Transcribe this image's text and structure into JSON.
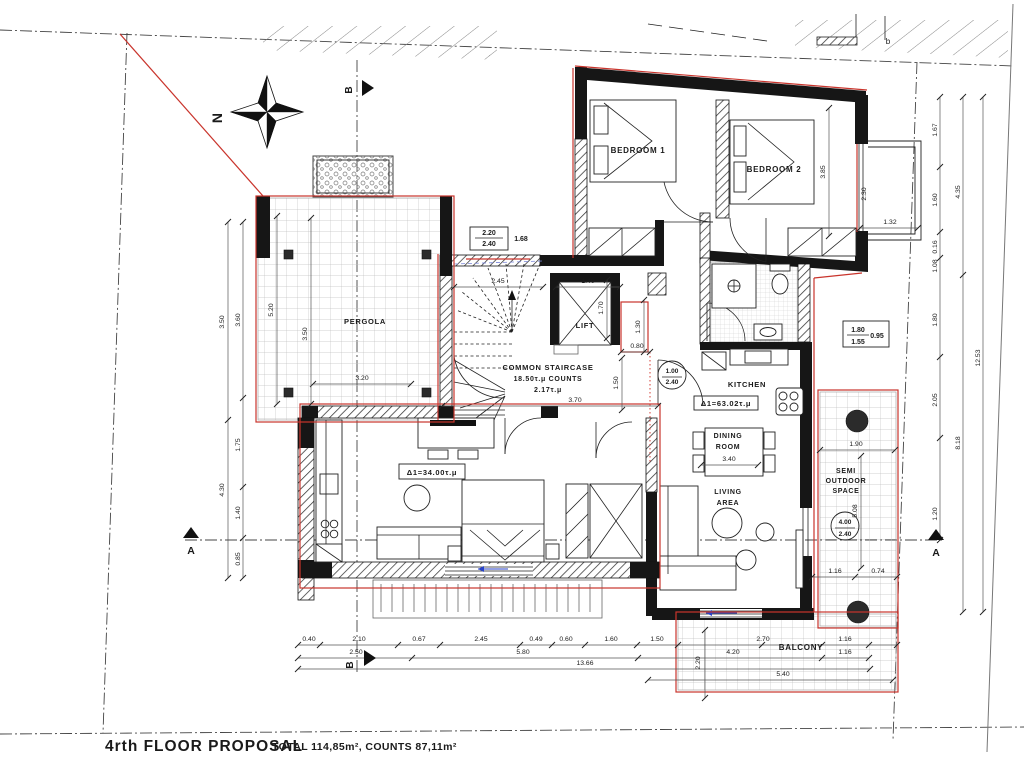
{
  "title": {
    "main": "4rth FLOOR PROPOSAL",
    "summary": "TOTAL 114,85m², COUNTS 87,11m²"
  },
  "compass": {
    "north": "N"
  },
  "site": {
    "plot_label": "b"
  },
  "sections": {
    "a": "A",
    "b": "B"
  },
  "rooms": {
    "bedroom1": "BEDROOM 1",
    "bedroom2": "BEDROOM 2",
    "lift": "LIFT",
    "staircase1": "COMMON STAIRCASE",
    "staircase2": "18.50τ.μ COUNTS",
    "staircase3": "2.17τ.μ",
    "kitchen": "KITCHEN",
    "apartment1_area": "Δ1=63.02τ.μ",
    "dining1": "DINING",
    "dining2": "ROOM",
    "living1": "LIVING",
    "living2": "AREA",
    "studio_area": "Δ1=34.00τ.μ",
    "pergola": "PERGOLA",
    "semi1": "SEMI",
    "semi2": "OUTDOOR",
    "semi3": "SPACE",
    "balcony": "BALCONY"
  },
  "openings": {
    "win_top_w": "2.20",
    "win_top_h": "2.40",
    "win_top_len": "1.68",
    "win_right_w": "1.80",
    "win_right_h": "1.55",
    "win_right_len": "0.95",
    "door_hall_w": "1.00",
    "door_hall_h": "2.40",
    "door_semi_w": "4.00",
    "door_semi_h": "2.40"
  },
  "dims": {
    "left_outer": [
      "3.50",
      "4.30"
    ],
    "left_inner": [
      "3.60",
      "1.75",
      "1.40",
      "0.85"
    ],
    "right_inner": [
      "1.67",
      "1.60",
      "0.16",
      "1.08",
      "1.80",
      "2.05",
      "1.20"
    ],
    "right_mid": [
      "4.35",
      "8.18"
    ],
    "right_outer": [
      "12.53"
    ],
    "bottom_row1": [
      "0.40",
      "2.10",
      "0.67",
      "2.45",
      "0.49",
      "0.60",
      "1.60",
      "1.50",
      "2.70",
      "1.16"
    ],
    "bottom_row2": [
      "2.50",
      "5.80",
      "4.20",
      "1.16"
    ],
    "bottom_row3": [
      "13.66"
    ],
    "bottom_row4": [
      "5.40"
    ],
    "stair": [
      "2.45",
      "1.40",
      "1.70",
      "1.30",
      "0.80",
      "1.50",
      "3.70"
    ],
    "pergola": [
      "5.20",
      "3.50",
      "3.20"
    ],
    "bedroom2": [
      "3.85"
    ],
    "bay": [
      "2.30",
      "1.32"
    ],
    "dining": [
      "3.40"
    ],
    "semi": [
      "1.90",
      "5.08",
      "1.16",
      "0.74"
    ],
    "balcony_depth": [
      "2.20"
    ]
  }
}
